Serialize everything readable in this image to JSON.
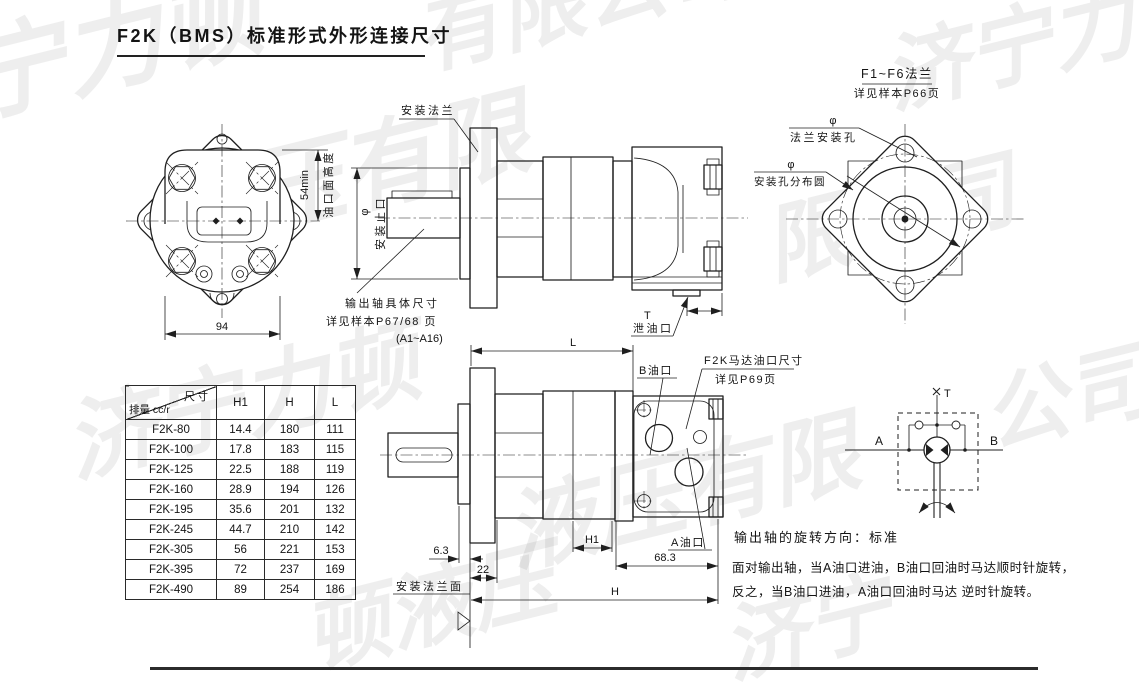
{
  "page": {
    "title": "F2K（BMS）标准形式外形连接尺寸"
  },
  "watermark": {
    "company": "济宁力顿液压有限公司",
    "tiles": [
      "宁力顿",
      "有限公司",
      "济宁力",
      "液压有限",
      "限公司",
      "济宁力顿",
      "液压有限",
      "公司",
      "顿液压",
      "济宁"
    ]
  },
  "flange_note": {
    "line1": "F1~F6法兰",
    "line2": "详见样本P66页"
  },
  "labels": {
    "dim94": "94",
    "dim54": "54min",
    "port_face_height": "油口面高度",
    "mount_flange": "安装法兰",
    "phi": "φ",
    "mount_spigot": "安装止口",
    "shaft_note1": "输出轴具体尺寸",
    "shaft_note2": "详见样本P67/68 页",
    "shaft_note3": "(A1~A16)",
    "t_port": "T",
    "drain_port": "泄油口",
    "flange_hole": "法兰安装孔",
    "hole_circle": "安装孔分布圆",
    "dimL": "L",
    "dimH": "H",
    "dimH1": "H1",
    "dim63": "6.3",
    "dim22": "22",
    "dim683": "68.3",
    "b_port": "B油口",
    "a_port": "A油口",
    "port_note1": "F2K马达油口尺寸",
    "port_note2": "详见P69页",
    "flange_face": "安装法兰面",
    "sym_T": "T",
    "sym_A": "A",
    "sym_B": "B"
  },
  "table": {
    "corner_top": "尺寸",
    "corner_bottom": "排量 cc/r",
    "columns": [
      "H1",
      "H",
      "L"
    ],
    "rows": [
      {
        "model": "F2K-80",
        "H1": "14.4",
        "H": "180",
        "L": "111"
      },
      {
        "model": "F2K-100",
        "H1": "17.8",
        "H": "183",
        "L": "115"
      },
      {
        "model": "F2K-125",
        "H1": "22.5",
        "H": "188",
        "L": "119"
      },
      {
        "model": "F2K-160",
        "H1": "28.9",
        "H": "194",
        "L": "126"
      },
      {
        "model": "F2K-195",
        "H1": "35.6",
        "H": "201",
        "L": "132"
      },
      {
        "model": "F2K-245",
        "H1": "44.7",
        "H": "210",
        "L": "142"
      },
      {
        "model": "F2K-305",
        "H1": "56",
        "H": "221",
        "L": "153"
      },
      {
        "model": "F2K-395",
        "H1": "72",
        "H": "237",
        "L": "169"
      },
      {
        "model": "F2K-490",
        "H1": "89",
        "H": "254",
        "L": "186"
      }
    ]
  },
  "notes": {
    "rotation": "输出轴的旋转方向：标准",
    "line2": "面对输出轴，当A油口进油，B油口回油时马达顺时针旋转，",
    "line3": "反之，当B油口进油，A油口回油时马达 逆时针旋转。"
  }
}
